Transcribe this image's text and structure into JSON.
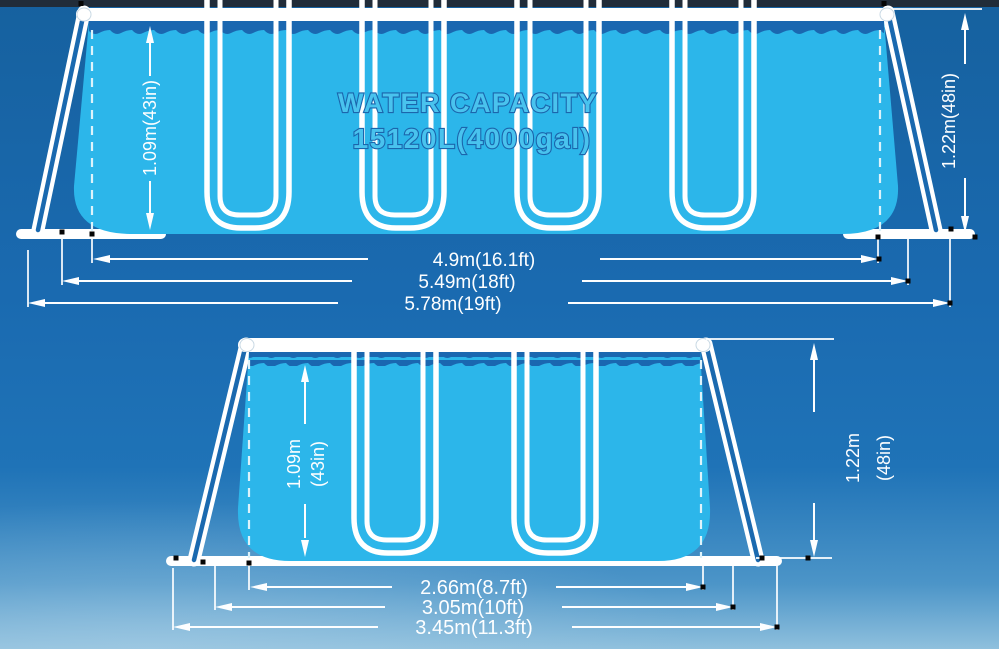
{
  "title": "Rectangular frame pool dimension diagram",
  "colors": {
    "background": "#1a6ab0",
    "background_bottom": "#8fc0dd",
    "water": "#2cb6ea",
    "wall_band": "#1a67b0",
    "frame_white": "#ffffff",
    "top_bar_navy": "#212c39",
    "dimension_text": "#fdfeff",
    "capacity_fill": "#49c3ee",
    "capacity_outline": "#1b65ac",
    "marker_black": "#050505"
  },
  "long_view": {
    "capacity_title": "WATER CAPACITY",
    "capacity_value": "15120L(4000gal)",
    "water_depth": "1.09m(43in)",
    "frame_height": "1.22m(48in)",
    "inner_width": "4.9m(16.1ft)",
    "top_width": "5.49m(18ft)",
    "base_width": "5.78m(19ft)"
  },
  "short_view": {
    "water_depth_m": "1.09m",
    "water_depth_in": "(43in)",
    "frame_height_m": "1.22m",
    "frame_height_in": "(48in)",
    "inner_width": "2.66m(8.7ft)",
    "top_width": "3.05m(10ft)",
    "base_width": "3.45m(11.3ft)"
  }
}
